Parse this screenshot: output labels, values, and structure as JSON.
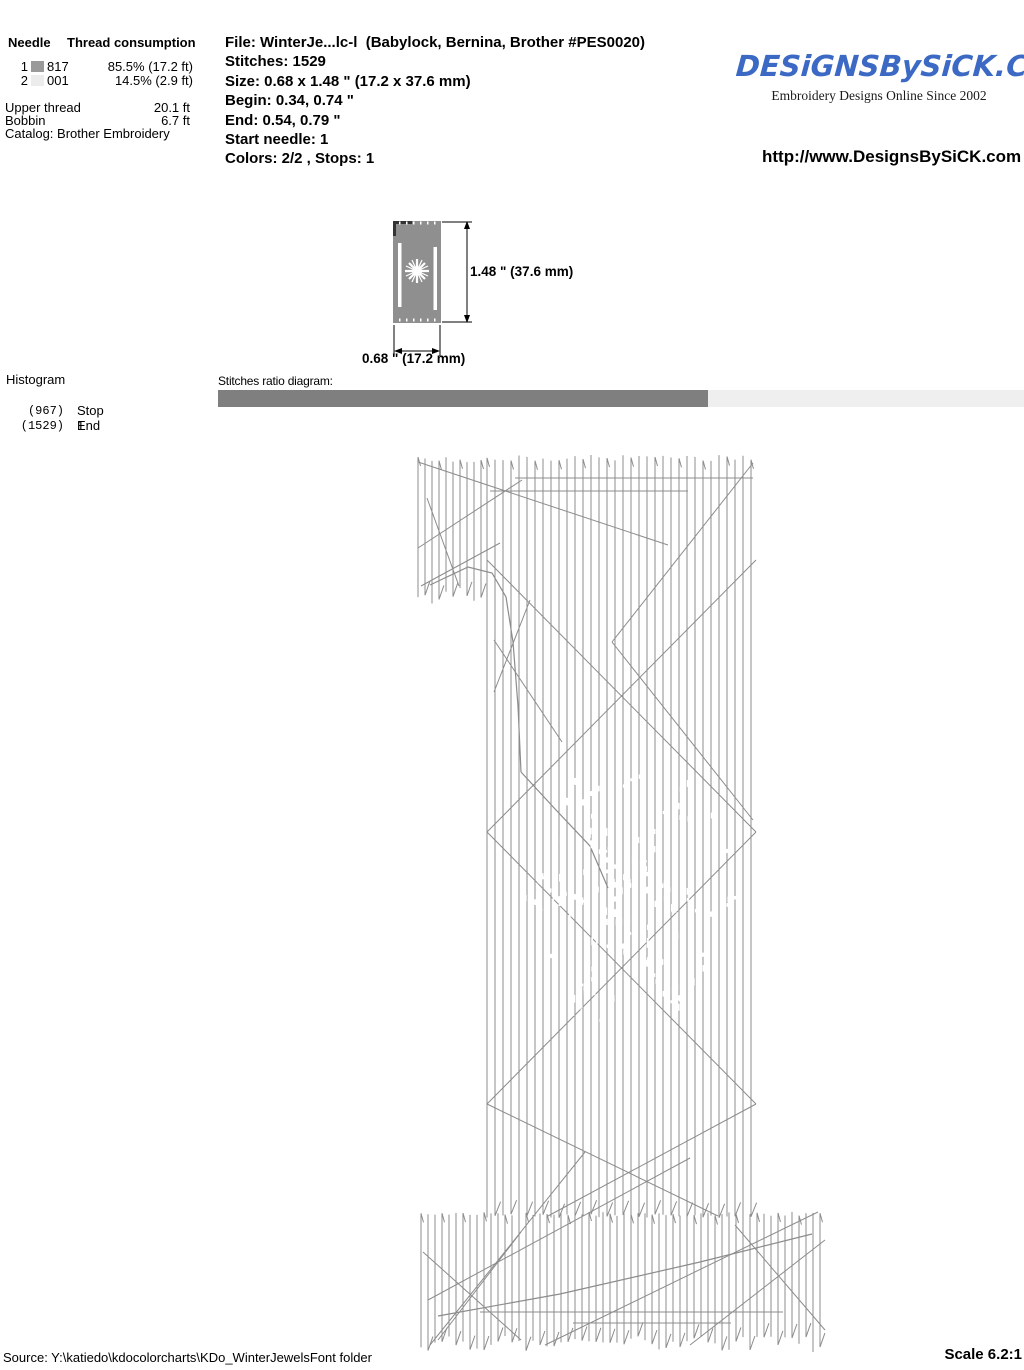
{
  "header": {
    "needle_table": {
      "col_needle": "Needle",
      "col_consumption": "Thread consumption",
      "rows": [
        {
          "needle": "1",
          "swatch": "#9a9a9a",
          "code": "817",
          "usage": "85.5% (17.2 ft)"
        },
        {
          "needle": "2",
          "swatch": "#ececec",
          "code": "001",
          "usage": "14.5% (2.9 ft)"
        }
      ],
      "upper_thread_label": "Upper thread",
      "upper_thread_value": "20.1 ft",
      "bobbin_label": "Bobbin",
      "bobbin_value": "6.7 ft",
      "catalog": "Catalog: Brother Embroidery"
    },
    "file_info": {
      "lines": [
        "File: WinterJe...lc-l  (Babylock, Bernina, Brother #PES0020)",
        "Stitches: 1529",
        "Size: 0.68 x 1.48 \" (17.2 x 37.6 mm)",
        "Begin: 0.34, 0.74 \"",
        "End: 0.54, 0.79 \"",
        "Start needle: 1",
        "Colors: 2/2 , Stops: 1"
      ]
    },
    "brand": {
      "logo_text": "DESiGNSBySiCK.COM",
      "logo_color": "#3b69c4",
      "tagline": "Embroidery Designs Online Since 2002",
      "url": "http://www.DesignsBySiCK.com"
    }
  },
  "dimension_figure": {
    "height_label": "1.48 \" (37.6 mm)",
    "width_label": "0.68 \" (17.2 mm)",
    "thumb_color": "#8f8f8f"
  },
  "histogram": {
    "title": "Histogram",
    "entries": [
      {
        "count": "(967)",
        "label": "Stop 1"
      },
      {
        "count": "(1529)",
        "label": "End"
      }
    ]
  },
  "ratio": {
    "label": "Stitches ratio diagram:",
    "dark_color": "#7f7f7f",
    "light_color": "#efefef",
    "dark_fraction": 0.608
  },
  "footer": {
    "source": "Source: Y:\\katiedo\\kdocolorcharts\\KDo_WinterJewelsFont folder",
    "scale": "Scale 6.2:1"
  },
  "stitch_diagram": {
    "color": "#8c8c8c",
    "regions": [
      {
        "name": "flag",
        "x1": 418,
        "x2": 487,
        "y1": 457,
        "y2": 588,
        "spacing": 7,
        "top_jitter": 6,
        "bottom_jitter": 16
      },
      {
        "name": "stem",
        "x1": 487,
        "x2": 756,
        "y1": 455,
        "y2": 1214,
        "spacing": 8,
        "top_jitter": 6,
        "bottom_jitter": 4
      },
      {
        "name": "base",
        "x1": 421,
        "x2": 824,
        "y1": 1212,
        "y2": 1336,
        "spacing": 7,
        "top_jitter": 4,
        "bottom_jitter": 16
      }
    ],
    "segments": [
      [
        515,
        478,
        753,
        478
      ],
      [
        490,
        491,
        688,
        491
      ],
      [
        418,
        462,
        668,
        545
      ],
      [
        418,
        548,
        522,
        480
      ],
      [
        421,
        586,
        500,
        543
      ],
      [
        427,
        498,
        459,
        586
      ],
      [
        753,
        463,
        612,
        642
      ],
      [
        612,
        642,
        753,
        820
      ],
      [
        487,
        560,
        756,
        832
      ],
      [
        756,
        560,
        487,
        832
      ],
      [
        487,
        832,
        756,
        1104
      ],
      [
        756,
        832,
        487,
        1104
      ],
      [
        487,
        1104,
        718,
        1216
      ],
      [
        756,
        1104,
        548,
        1216
      ],
      [
        530,
        600,
        494,
        692
      ],
      [
        494,
        640,
        562,
        742
      ],
      [
        430,
        1345,
        585,
        1152
      ],
      [
        428,
        1300,
        690,
        1158
      ],
      [
        545,
        1345,
        818,
        1212
      ],
      [
        690,
        1345,
        825,
        1240
      ],
      [
        825,
        1330,
        735,
        1225
      ],
      [
        423,
        1252,
        521,
        1340
      ],
      [
        521,
        1232,
        438,
        1340
      ],
      [
        480,
        1312,
        783,
        1312
      ],
      [
        573,
        1323,
        731,
        1323
      ]
    ],
    "paths": [
      [
        [
          430,
          585
        ],
        [
          468,
          567
        ],
        [
          492,
          573
        ],
        [
          506,
          597
        ],
        [
          513,
          642
        ],
        [
          518,
          706
        ],
        [
          521,
          772
        ]
      ],
      [
        [
          521,
          772
        ],
        [
          556,
          810
        ],
        [
          590,
          846
        ],
        [
          608,
          888
        ]
      ],
      [
        [
          438,
          1316
        ],
        [
          560,
          1294
        ],
        [
          700,
          1262
        ],
        [
          812,
          1234
        ]
      ]
    ],
    "snowflake": {
      "cx": 628,
      "cy": 902,
      "r": 140,
      "core": 45,
      "arm_width": 16,
      "noise": 0.16,
      "count": 850,
      "color": "#ffffff"
    }
  }
}
